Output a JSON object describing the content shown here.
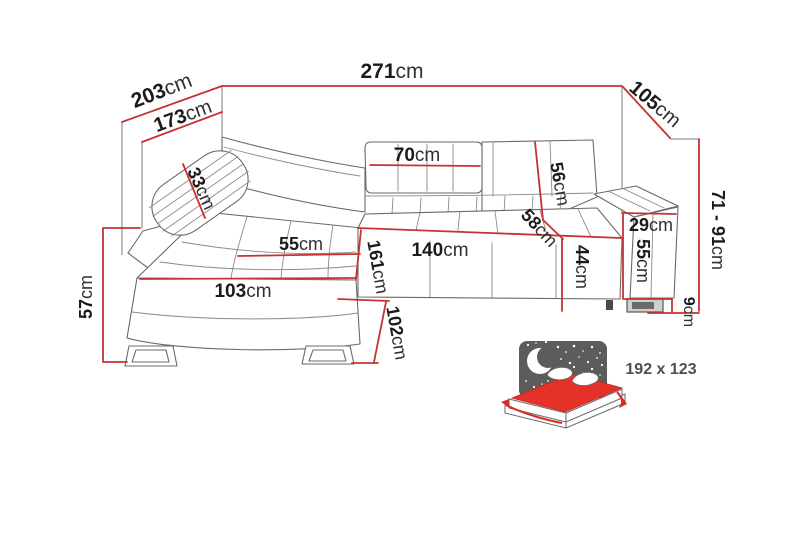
{
  "dims": {
    "width_total": {
      "v": "271",
      "u": "cm"
    },
    "depth_total": {
      "v": "203",
      "u": "cm"
    },
    "depth_inner": {
      "v": "173",
      "u": "cm"
    },
    "side_depth": {
      "v": "105",
      "u": "cm"
    },
    "height_range": {
      "v": "71 - 91",
      "u": "cm"
    },
    "pillow_width": {
      "v": "33",
      "u": "cm"
    },
    "headrest_width": {
      "v": "70",
      "u": "cm"
    },
    "backrest_height": {
      "v": "56",
      "u": "cm"
    },
    "seat_depth": {
      "v": "58",
      "u": "cm"
    },
    "armrest_width": {
      "v": "29",
      "u": "cm"
    },
    "armrest_height": {
      "v": "55",
      "u": "cm"
    },
    "seat_height": {
      "v": "44",
      "u": "cm"
    },
    "seat_width": {
      "v": "140",
      "u": "cm"
    },
    "chaise_length": {
      "v": "161",
      "u": "cm"
    },
    "chaise_seat_width": {
      "v": "55",
      "u": "cm"
    },
    "chaise_front_len": {
      "v": "103",
      "u": "cm"
    },
    "chaise_height": {
      "v": "57",
      "u": "cm"
    },
    "front_height": {
      "v": "102",
      "u": "cm"
    },
    "leg_height": {
      "v": "9",
      "u": "cm"
    }
  },
  "sleeping": {
    "size_label": "192 x 123"
  },
  "icons": {
    "night": "crescent-moon-and-stars",
    "bed": "fold-out-bed"
  },
  "colors": {
    "dimension_line": "#c63232",
    "mattress": "#e53228",
    "night_panel": "#5c5c5c",
    "outline": "#6a6a6a"
  }
}
